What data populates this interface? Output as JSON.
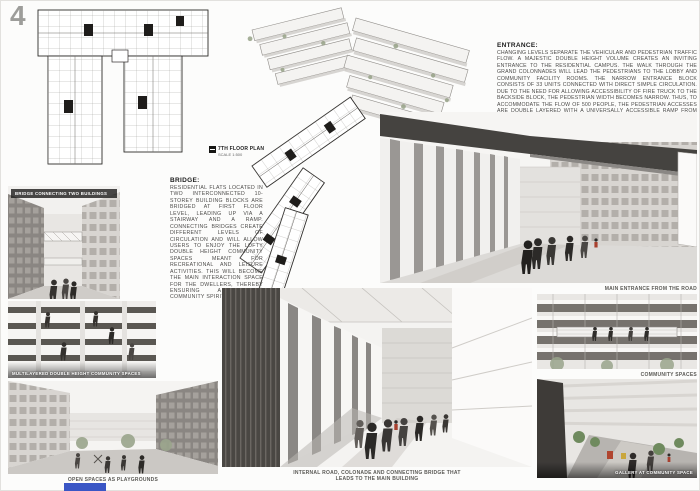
{
  "board": {
    "page_number": "4",
    "accent_blue": "#3a56c5"
  },
  "plan_label": {
    "title": "7TH FLOOR PLAN",
    "scale": "SCALE 1:500"
  },
  "icons": {
    "plan_marker": "scale-marker-icon"
  },
  "entrance": {
    "heading": "ENTRANCE:",
    "body": "CHANGING LEVELS SEPARATE THE VEHICULAR AND PEDESTRIAN TRAFFIC FLOW. A MAJESTIC DOUBLE HEIGHT VOLUME CREATES AN INVITING ENTRANCE TO THE RESIDENTIAL CAMPUS. THE WALK THROUGH THE GRAND COLONNADES WILL LEAD THE PEDESTRIANS TO THE LOBBY AND COMMUNITY FACILITY ROOMS. THE NARROW ENTRANCE BLOCK CONSISTS OF 33 UNITS CONNECTED WITH DIRECT SIMPLE CIRCULATION. DUE TO THE NEED FOR ALLOWING ACCESSIBILITY OF FIRE TRUCK TO THE BACKSIDE BLOCK, THE PEDESTRIAN WIDTH BECOMES NARROW. THUS, TO ACCOMMODATE THE FLOW OF 500 PEOPLE, THE PEDESTRIAN ACCESSES ARE DOUBLE LAYERED WITH A UNIVERSALLY ACCESSIBLE RAMP FROM GROUND LEVEL AND AN INTERNAL STAIRWAY BOUND BY THE ENTRANCE COLONNADES SPACE."
  },
  "bridge": {
    "heading": "BRIDGE:",
    "body": "RESIDENTIAL FLATS LOCATED IN TWO INTERCONNECTED 10-STOREY BUILDING BLOCKS ARE BRIDGED AT FIRST FLOOR LEVEL, LEADING UP VIA A STAIRWAY AND A RAMP. CONNECTING BRIDGES CREATE DIFFERENT LEVELS OF CIRCULATION AND WILL ALLOW USERS TO ENJOY THE LOFTY DOUBLE HEIGHT COMMUNITY SPACES MEANT FOR RECREATIONAL AND LEISURE ACTIVITIES. THIS WILL BECOME THE MAIN INTERACTION SPACE FOR THE DWELLERS, THEREBY ENSURING A STRONG COMMUNITY SPIRIT."
  },
  "captions": {
    "bridge_photo": "BRIDGE CONNECTING TWO BUILDINGS",
    "community_photo": "MULTILAYERED DOUBLE HEIGHT COMMUNITY SPACES",
    "playground_photo": "OPEN SPACES AS PLAYGROUNDS",
    "main_entrance_photo": "MAIN ENTRANCE FROM THE ROAD",
    "community_spaces_photo": "COMMUNITY SPACES",
    "internal_road_photo": "INTERNAL ROAD, COLONADE AND CONNECTING BRIDGE THAT LEADS TO THE MAIN BUILDING",
    "gallery_photo": "GALLERY AT COMMUNITY SPACE"
  }
}
